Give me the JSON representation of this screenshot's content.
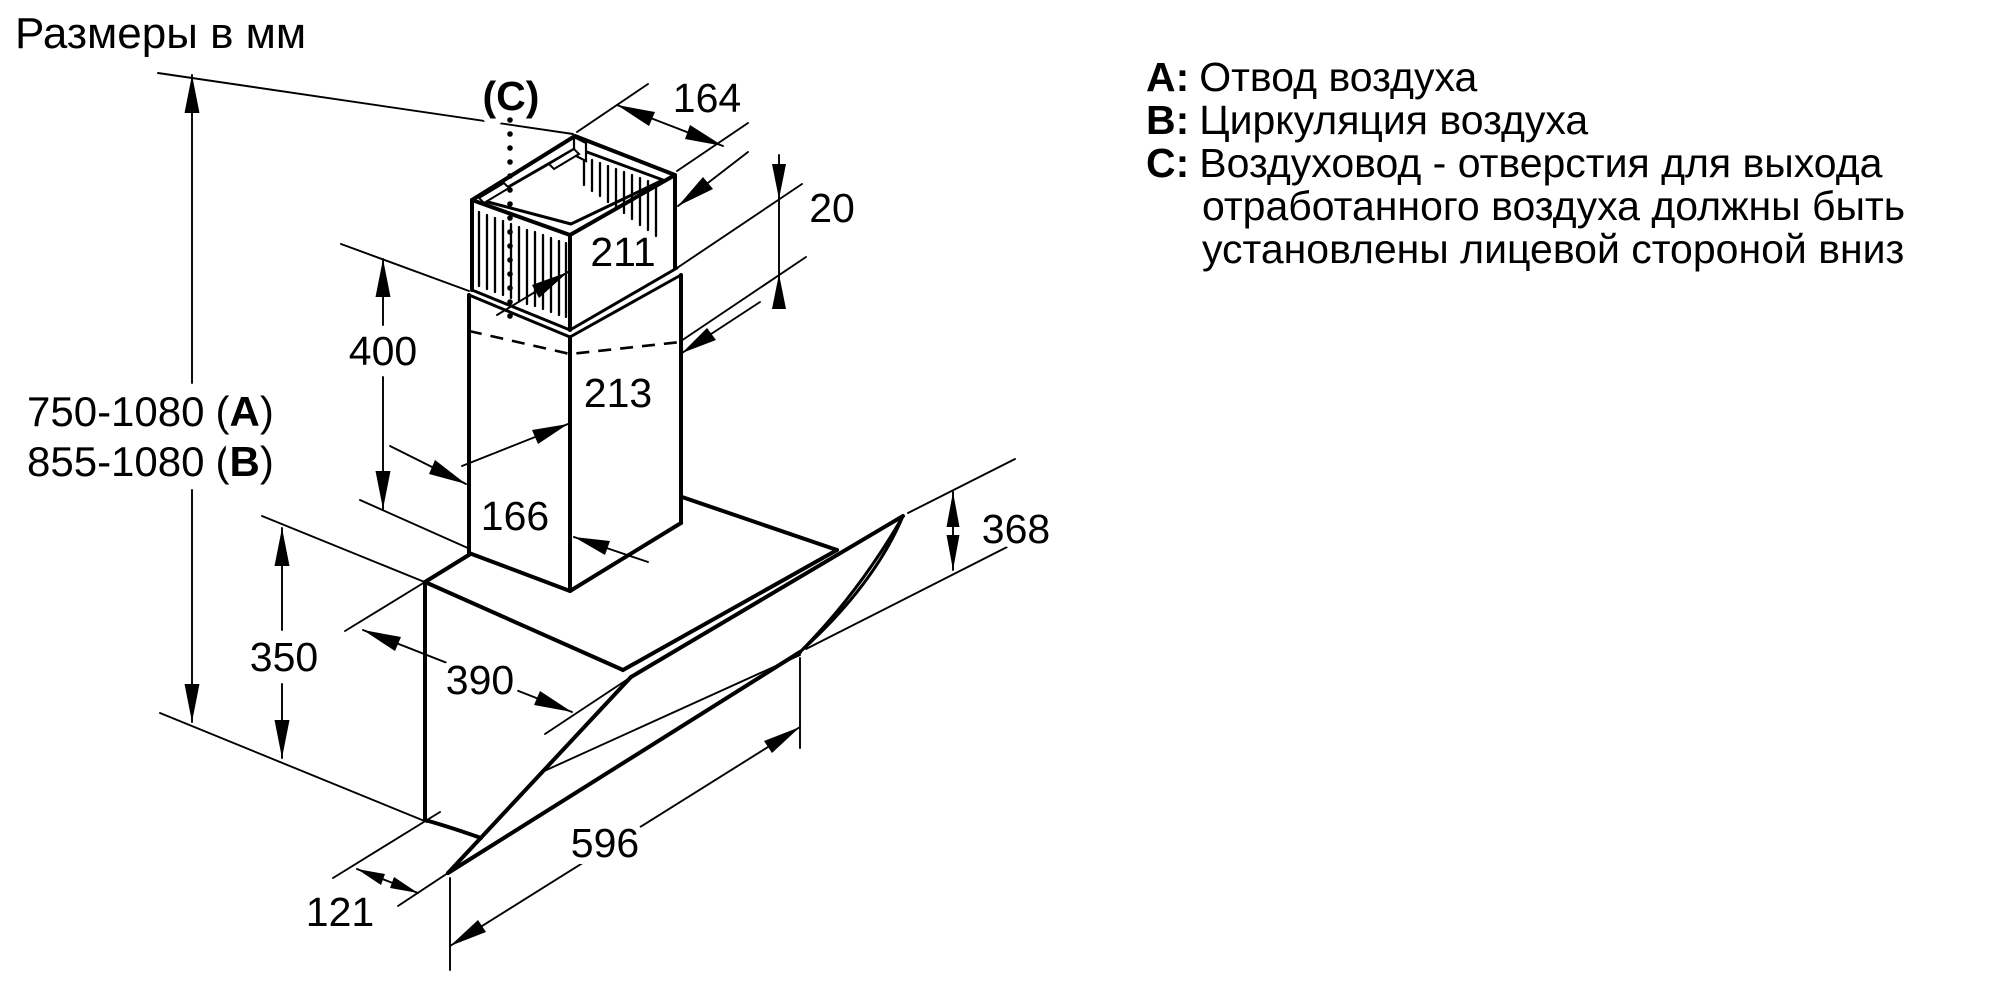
{
  "title": "Размеры в мм",
  "diagram": {
    "duct_label": "(C)",
    "dim_labels": {
      "top_width": "164",
      "overlap": "20",
      "upper_duct_depth": "211",
      "lower_duct_height": "400",
      "lower_duct_depth": "213",
      "lower_duct_width": "166",
      "hood_back_height": "350",
      "hood_top_depth": "390",
      "glass_height": "368",
      "hood_width": "596",
      "bottom_depth": "121"
    },
    "wall_ranges": {
      "a": {
        "range": "750-1080",
        "open": "(",
        "letter": "A",
        "close": ")"
      },
      "b": {
        "range": "855-1080",
        "open": "(",
        "letter": "B",
        "close": ")"
      }
    }
  },
  "legend": {
    "items": [
      {
        "letter": "A:",
        "text": "Отвод воздуха"
      },
      {
        "letter": "B:",
        "text": "Циркуляция воздуха"
      },
      {
        "letter": "C:",
        "text": "Воздуховод - отверстия для выхода отработанного воздуха должны быть установлены лицевой стороной вниз"
      }
    ]
  }
}
